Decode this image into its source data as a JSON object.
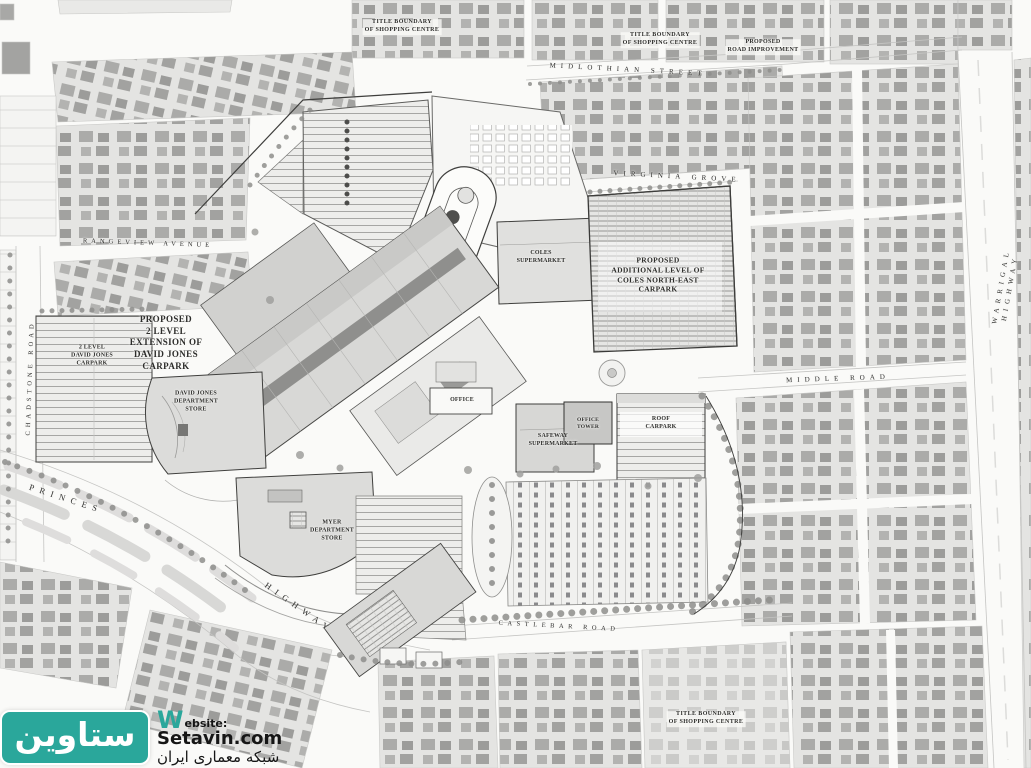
{
  "plan": {
    "type": "architectural-site-plan",
    "colors": {
      "paper": "#fafaf8",
      "parcel": "#e4e4e2",
      "house": "#a5a5a3",
      "building": "#d8d8d6",
      "outline": "#454543",
      "label_ink": "#2d2d2b"
    }
  },
  "plan_labels": [
    {
      "id": "title-boundary-nw",
      "text": "TITLE BOUNDARY\nOF SHOPPING CENTRE",
      "x": 402,
      "y": 27,
      "rot": 0,
      "size": 6,
      "ls": 0.4,
      "weight": 700,
      "bg": true
    },
    {
      "id": "title-boundary-ne",
      "text": "TITLE BOUNDARY\nOF SHOPPING CENTRE",
      "x": 660,
      "y": 40,
      "rot": 0,
      "size": 6,
      "ls": 0.4,
      "weight": 700,
      "bg": true
    },
    {
      "id": "proposed-road-improvement",
      "text": "PROPOSED\nROAD IMPROVEMENT",
      "x": 763,
      "y": 47,
      "rot": 0,
      "size": 6,
      "ls": 0.3,
      "weight": 700,
      "bg": true
    },
    {
      "id": "title-boundary-se",
      "text": "TITLE BOUNDARY\nOF SHOPPING CENTRE",
      "x": 706,
      "y": 719,
      "rot": 0,
      "size": 6,
      "ls": 0.4,
      "weight": 700,
      "bg": true
    },
    {
      "id": "midlothian-street",
      "text": "MIDLOTHIAN STREET",
      "x": 628,
      "y": 70,
      "rot": 3,
      "size": 7,
      "ls": 5,
      "weight": 400
    },
    {
      "id": "virginia-grove",
      "text": "VIRGINIA GROVE",
      "x": 677,
      "y": 177,
      "rot": 3,
      "size": 7,
      "ls": 5,
      "weight": 400
    },
    {
      "id": "rangeview-avenue",
      "text": "RANGEVIEW AVENUE",
      "x": 148,
      "y": 244,
      "rot": 2,
      "size": 6.5,
      "ls": 4,
      "weight": 400
    },
    {
      "id": "warrigal-highway",
      "text": "WARRIGAL HIGHWAY",
      "x": 1006,
      "y": 287,
      "rot": -80,
      "size": 7,
      "ls": 5,
      "weight": 400
    },
    {
      "id": "middle-road",
      "text": "MIDDLE ROAD",
      "x": 838,
      "y": 379,
      "rot": -2,
      "size": 7,
      "ls": 5,
      "weight": 400
    },
    {
      "id": "chadstone-road",
      "text": "CHADSTONE ROAD",
      "x": 31,
      "y": 378,
      "rot": -88,
      "size": 6.5,
      "ls": 4,
      "weight": 400
    },
    {
      "id": "princes",
      "text": "PRINCES",
      "x": 66,
      "y": 499,
      "rot": 18,
      "size": 8.5,
      "ls": 6,
      "weight": 400
    },
    {
      "id": "highway",
      "text": "HIGHWAY",
      "x": 299,
      "y": 608,
      "rot": 35,
      "size": 8.5,
      "ls": 6,
      "weight": 400
    },
    {
      "id": "castlebar-road",
      "text": "CASTLEBAR ROAD",
      "x": 559,
      "y": 627,
      "rot": 3,
      "size": 6.5,
      "ls": 4.5,
      "weight": 400
    },
    {
      "id": "proposed-dj-extension",
      "text": "PROPOSED\n2 LEVEL\nEXTENSION OF\nDAVID JONES\nCARPARK",
      "x": 166,
      "y": 343,
      "rot": 0,
      "size": 9,
      "ls": 0.4,
      "weight": 700
    },
    {
      "id": "dj-carpark",
      "text": "2 LEVEL\nDAVID JONES\nCARPARK",
      "x": 92,
      "y": 356,
      "rot": 0,
      "size": 6,
      "ls": 0.2,
      "weight": 700
    },
    {
      "id": "dj-store",
      "text": "DAVID JONES\nDEPARTMENT\nSTORE",
      "x": 196,
      "y": 402,
      "rot": 0,
      "size": 6,
      "ls": 0.2,
      "weight": 700
    },
    {
      "id": "coles-supermarket",
      "text": "COLES\nSUPERMARKET",
      "x": 541,
      "y": 258,
      "rot": 0,
      "size": 6,
      "ls": 0.2,
      "weight": 700
    },
    {
      "id": "coles-ne-carpark",
      "text": "PROPOSED\nADDITIONAL LEVEL OF\nCOLES NORTH-EAST\nCARPARK",
      "x": 658,
      "y": 275,
      "rot": 0,
      "size": 7.5,
      "ls": 0.3,
      "weight": 700
    },
    {
      "id": "office",
      "text": "OFFICE",
      "x": 462,
      "y": 401,
      "rot": 0,
      "size": 6,
      "ls": 0.2,
      "weight": 700
    },
    {
      "id": "office-tower",
      "text": "OFFICE\nTOWER",
      "x": 588,
      "y": 424,
      "rot": 0,
      "size": 5.5,
      "ls": 0.2,
      "weight": 700
    },
    {
      "id": "safeway-supermarket",
      "text": "SAFEWAY\nSUPERMARKET",
      "x": 553,
      "y": 441,
      "rot": 0,
      "size": 6,
      "ls": 0.2,
      "weight": 700
    },
    {
      "id": "roof-carpark",
      "text": "ROOF\nCARPARK",
      "x": 661,
      "y": 424,
      "rot": 0,
      "size": 6,
      "ls": 0.2,
      "weight": 700
    },
    {
      "id": "myer",
      "text": "MYER\nDEPARTMENT\nSTORE",
      "x": 332,
      "y": 531,
      "rot": 0,
      "size": 6,
      "ls": 0.2,
      "weight": 700
    }
  ],
  "watermark": {
    "brand_fa": "ستاوين",
    "w_initial": "W",
    "website_rest": "ebsite:",
    "domain": "Setavin.com",
    "tagline_fa": "شبكه معمارى ايران",
    "teal": "#2aa79b"
  }
}
